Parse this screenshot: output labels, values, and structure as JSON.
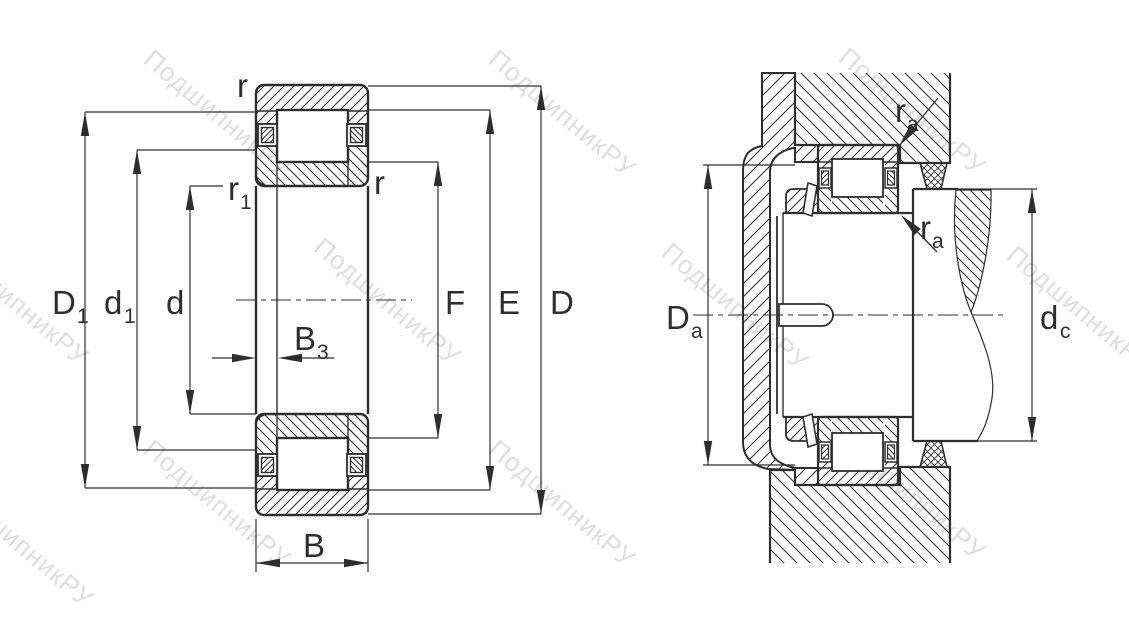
{
  "watermark": {
    "text": "ПодшипникРУ",
    "color": "#c9c9c9"
  },
  "line_color": "#2e2e2e",
  "left_view": {
    "labels": {
      "r_top": "r",
      "r1_main": "r",
      "r1_sub": "1",
      "r_right": "r",
      "D1_main": "D",
      "D1_sub": "1",
      "d1_main": "d",
      "d1_sub": "1",
      "d": "d",
      "B3_main": "B",
      "B3_sub": "3",
      "B": "B",
      "F": "F",
      "E": "E",
      "D": "D"
    }
  },
  "right_view": {
    "labels": {
      "ra_top_main": "r",
      "ra_top_sub": "a",
      "ra_bottom_main": "r",
      "ra_bottom_sub": "a",
      "Da_main": "D",
      "Da_sub": "a",
      "dc_main": "d",
      "dc_sub": "c"
    }
  }
}
